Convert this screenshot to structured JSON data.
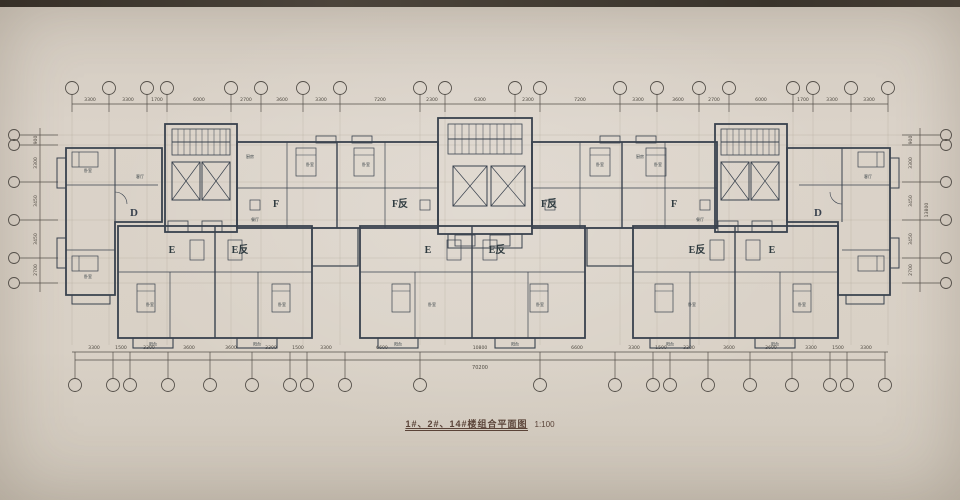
{
  "title": {
    "text": "1#、2#、14#楼组合平面图",
    "scale": "1:100"
  },
  "units": {
    "d": "D",
    "e": "E",
    "e_rev": "E反",
    "f": "F",
    "f_rev": "F反"
  },
  "rooms": {
    "bedroom": "卧室",
    "living": "客厅",
    "dining": "餐厅",
    "kitchen": "厨房",
    "balcony": "阳台",
    "bath": "卫生间"
  },
  "dims": {
    "top": [
      "3300",
      "3300",
      "1700",
      "6000",
      "2700",
      "3600",
      "3300",
      "7200",
      "2300",
      "6300",
      "2300",
      "7200",
      "3300",
      "3600",
      "2700",
      "6000",
      "1700",
      "3300",
      "3300"
    ],
    "bottom": [
      "3300",
      "1500",
      "3300",
      "3600",
      "3600",
      "3300",
      "1500",
      "3300",
      "6600",
      "10800",
      "6600",
      "3300",
      "1500",
      "3300",
      "3600",
      "3600",
      "3300",
      "1500",
      "3300"
    ],
    "bottom_total": "70200",
    "left": [
      "900",
      "3300",
      "3450",
      "3450",
      "2700"
    ],
    "right": [
      "900",
      "3300",
      "3450",
      "3450",
      "2700"
    ],
    "right_total": "13800"
  },
  "colors": {
    "unit_d": "#e6e3a0",
    "unit_e": "#a6cbb9",
    "unit_f": "#cfa2ba",
    "core": "#98a0a8",
    "wall": "#39424e",
    "paper": "#d7cfc5"
  }
}
